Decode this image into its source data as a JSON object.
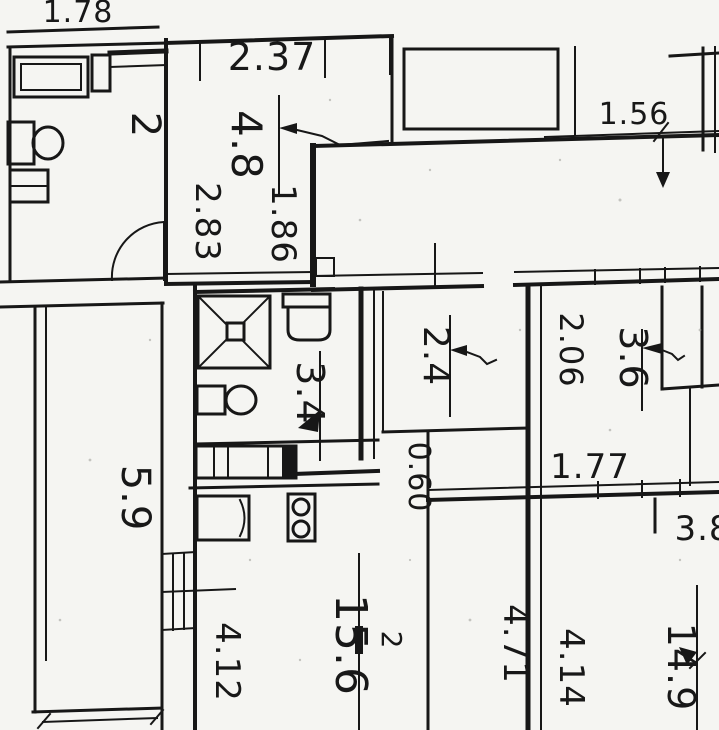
{
  "document": {
    "kind": "scanned apartment floor plan",
    "ink_color": "#171717",
    "paper_color": "#f5f5f2"
  },
  "labels": [
    {
      "id": "dim-top-left",
      "text": "1.78"
    },
    {
      "id": "dim-top-middle",
      "text": "2.37"
    },
    {
      "id": "dim-room-top",
      "text": "4.8"
    },
    {
      "id": "dim-283",
      "text": "2.83"
    },
    {
      "id": "dim-186",
      "text": "1.86"
    },
    {
      "id": "room-wc-area",
      "text": "2"
    },
    {
      "id": "dim-156",
      "text": "1.56"
    },
    {
      "id": "room-left-area",
      "text": "5.9"
    },
    {
      "id": "room-bath-area",
      "text": "3.4"
    },
    {
      "id": "dim-24",
      "text": "2.4"
    },
    {
      "id": "dim-060",
      "text": "0.60"
    },
    {
      "id": "dim-206",
      "text": "2.06"
    },
    {
      "id": "dim-36",
      "text": "3.6"
    },
    {
      "id": "dim-177",
      "text": "1.77"
    },
    {
      "id": "dim-412",
      "text": "4.12"
    },
    {
      "id": "room-living-area",
      "text": "15.6"
    },
    {
      "id": "room-living-area-sup",
      "text": "2"
    },
    {
      "id": "dim-471",
      "text": "4.71"
    },
    {
      "id": "dim-414",
      "text": "4.14"
    },
    {
      "id": "room-br-area",
      "text": "14.9"
    },
    {
      "id": "dim-38",
      "text": "3.8"
    }
  ]
}
